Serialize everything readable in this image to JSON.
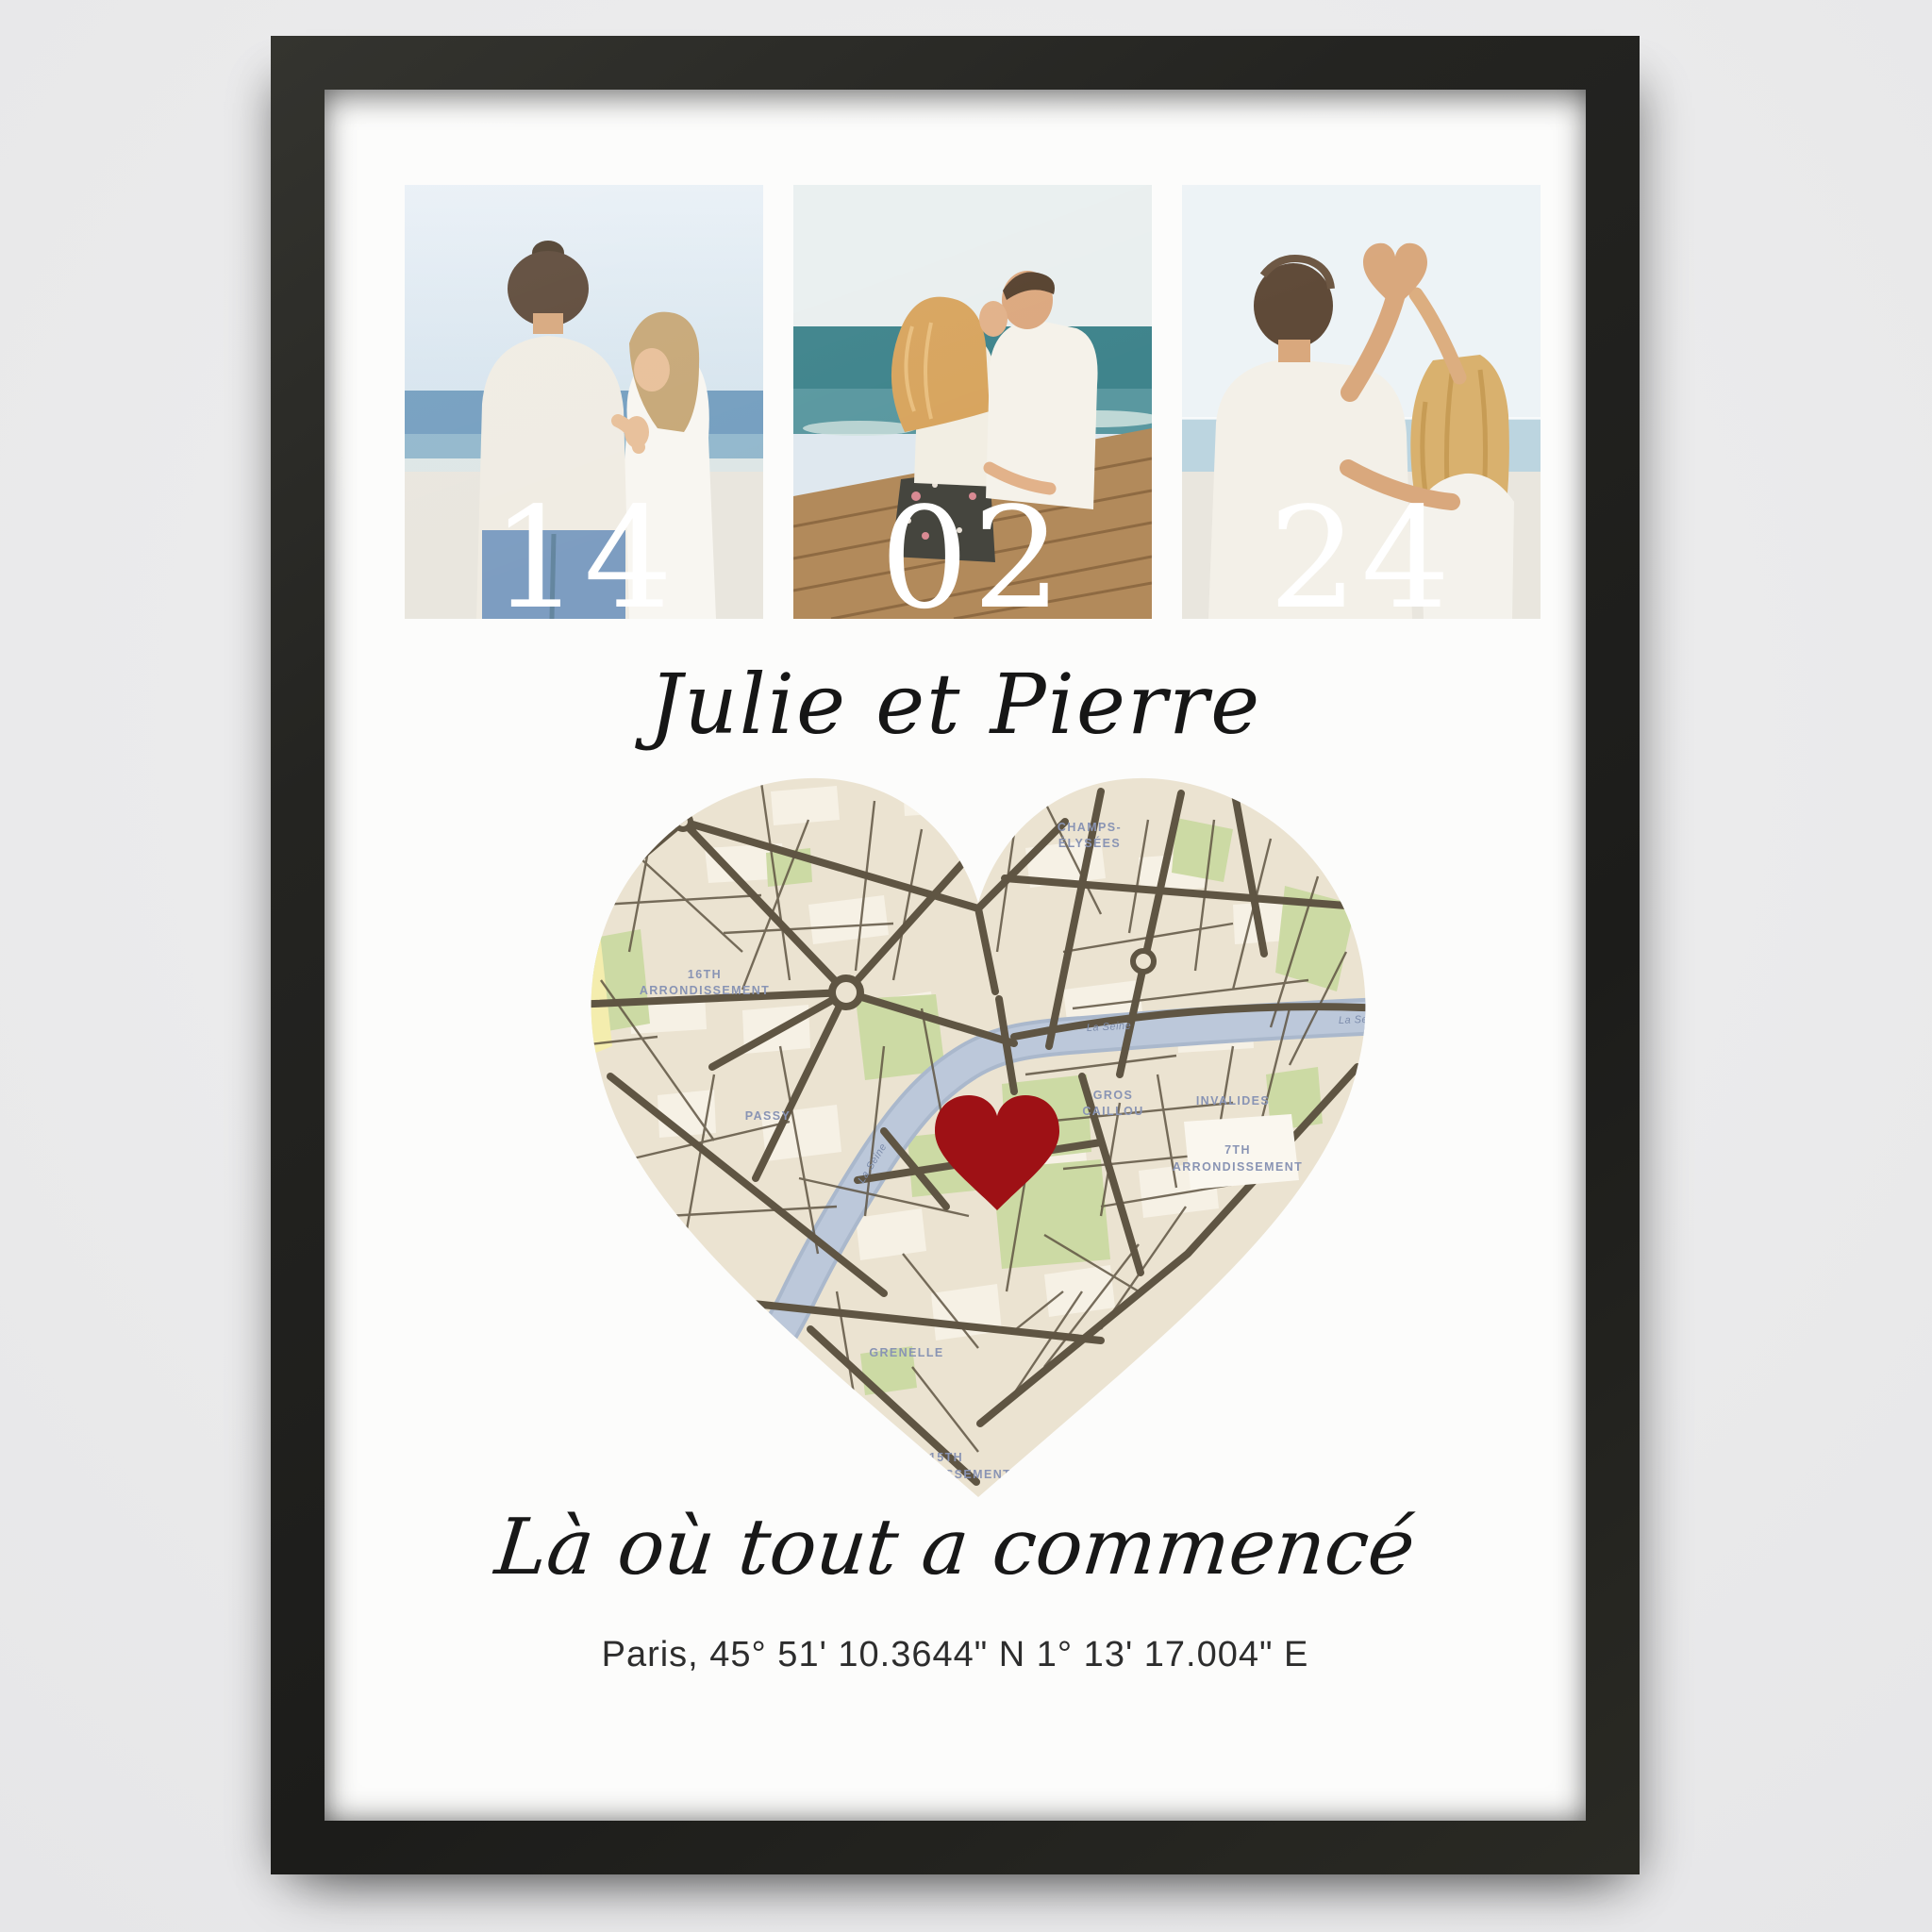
{
  "poster": {
    "dates": [
      "14",
      "02",
      "24"
    ],
    "names": "Julie et Pierre",
    "tagline": "Là où tout a commencé",
    "coordinates": "Paris, 45° 51' 10.3644\" N 1° 13' 17.004\" E"
  },
  "map": {
    "labels": {
      "arr16_l1": "16TH",
      "arr16_l2": "ARRONDISSEMENT",
      "passy": "PASSY",
      "champs_l1": "CHAMPS-",
      "champs_l2": "ÉLYSÉES",
      "gros_l1": "GROS",
      "gros_l2": "CAILLOU",
      "invalides": "INVALIDES",
      "arr7_l1": "7TH",
      "arr7_l2": "ARRONDISSEMENT",
      "grenelle": "GRENELLE",
      "arr15_l1": "15TH",
      "arr15_l2": "ARRONDISSEMENT",
      "seine_1": "La Seine",
      "seine_2": "La Seine",
      "seine_3": "La Seine"
    }
  },
  "colors": {
    "background": "#ebebec",
    "frame": "#232320",
    "mat": "#fcfcfb",
    "map_base": "#ebe3d1",
    "map_road": "#5f5543",
    "map_park": "#ccdaa4",
    "map_river": "#b8c4d7",
    "map_label": "#8994b4",
    "marker_red": "#9e1115",
    "date_text": "#ffffff",
    "text_dark": "#181818"
  }
}
